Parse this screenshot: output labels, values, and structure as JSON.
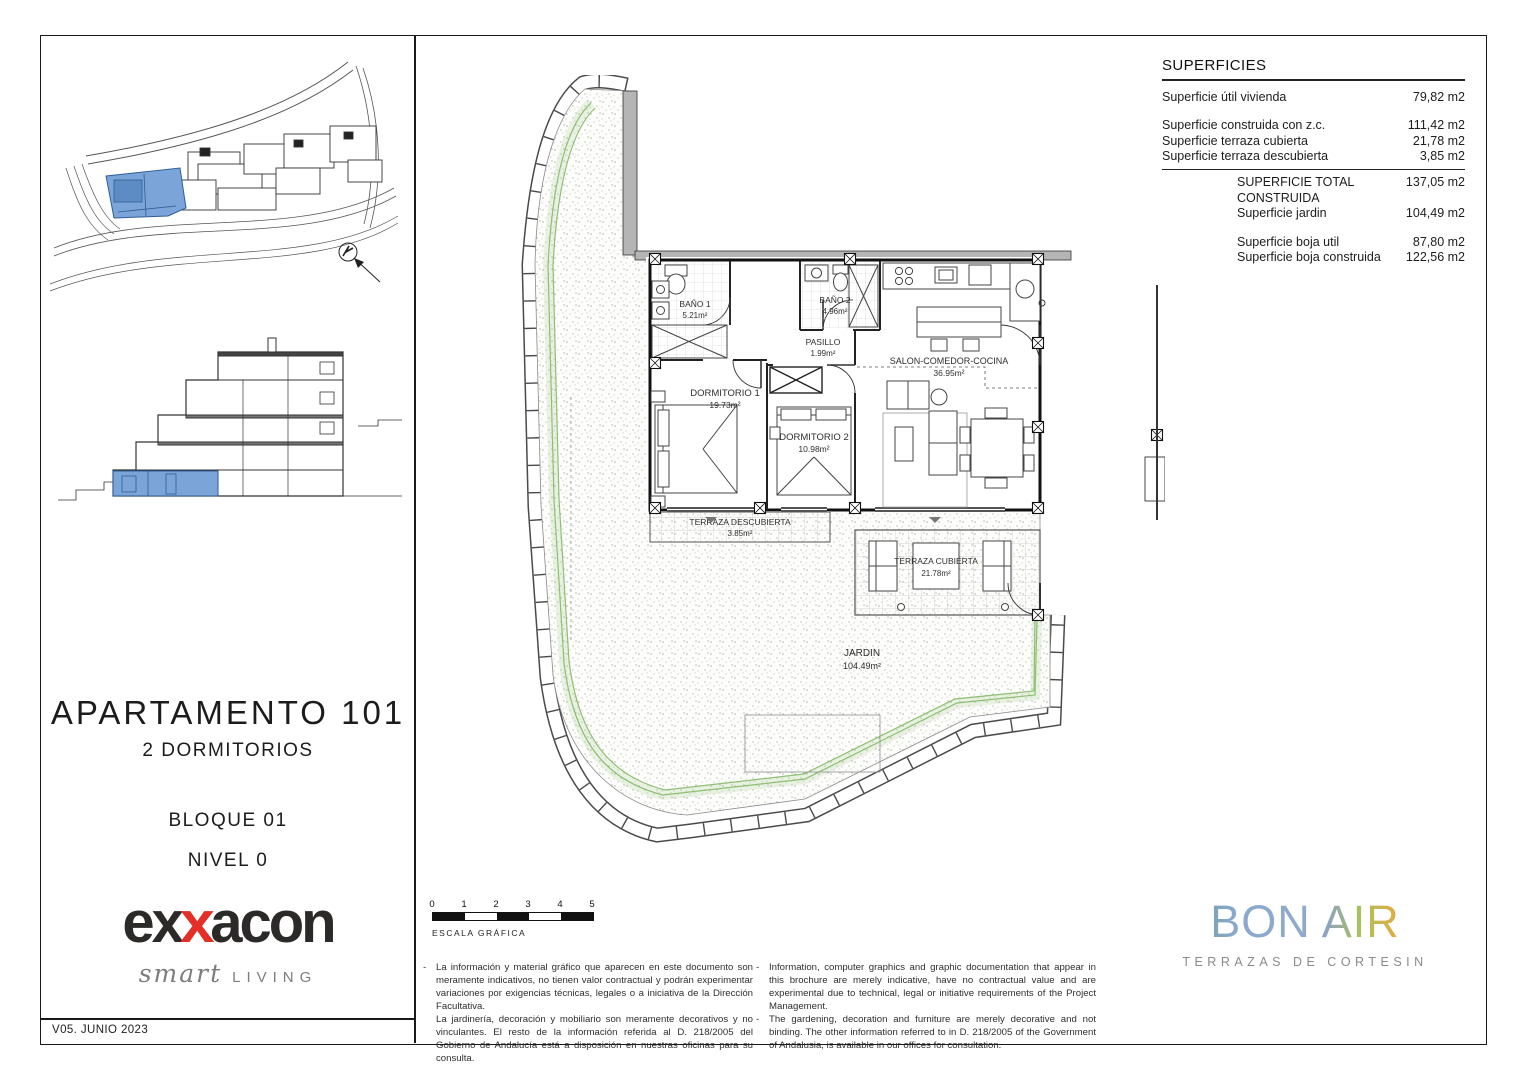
{
  "page": {
    "version": "V05. JUNIO 2023"
  },
  "title_block": {
    "title": "APARTAMENTO 101",
    "subtitle": "2 DORMITORIOS",
    "block": "BLOQUE 01",
    "level": "NIVEL 0"
  },
  "superficies": {
    "heading": "SUPERFICIES",
    "rows": [
      {
        "label": "Superficie útil vivienda",
        "value": "79,82 m2"
      },
      {
        "label": "Superficie construida con z.c.",
        "value": "111,42 m2"
      },
      {
        "label": "Superficie terraza cubierta",
        "value": "21,78 m2"
      },
      {
        "label": "Superficie terraza descubierta",
        "value": "3,85 m2"
      },
      {
        "label": "SUPERFICIE TOTAL CONSTRUIDA",
        "value": "137,05 m2"
      },
      {
        "label": "Superficie jardin",
        "value": "104,49 m2"
      },
      {
        "label": "Superficie boja util",
        "value": "87,80 m2"
      },
      {
        "label": "Superficie boja construida",
        "value": "122,56 m2"
      }
    ]
  },
  "plan": {
    "rooms": [
      {
        "name": "BAÑO 1",
        "area": "5.21m²"
      },
      {
        "name": "BAÑO 2",
        "area": "4.96m²"
      },
      {
        "name": "PASILLO",
        "area": "1.99m²"
      },
      {
        "name": "DORMITORIO 1",
        "area": "19.73m²"
      },
      {
        "name": "DORMITORIO 2",
        "area": "10.98m²"
      },
      {
        "name": "SALON-COMEDOR-COCINA",
        "area": "36.95m²"
      },
      {
        "name": "TERRAZA DESCUBIERTA",
        "area": "3.85m²"
      },
      {
        "name": "TERRAZA CUBIERTA",
        "area": "21.78m²"
      },
      {
        "name": "JARDIN",
        "area": "104.49m²"
      }
    ]
  },
  "scale_bar": {
    "ticks": [
      "0",
      "1",
      "2",
      "3",
      "4",
      "5"
    ],
    "label": "ESCALA GRÁFICA"
  },
  "disclaimer": {
    "bullet": "-",
    "es": [
      "La información y material gráfico que aparecen en este documento son meramente indicativos, no tienen valor contractual y podrán experimentar variaciones por exigencias técnicas, legales o a iniciativa de la Dirección Facultativa.",
      "La jardinería, decoración y mobiliario son meramente decorativos y no vinculantes. El resto de la información referida al D. 218/2005 del Gobierno de Andalucía está a disposición en nuestras oficinas para su consulta."
    ],
    "en": [
      "Information, computer graphics and graphic documentation that appear in this brochure are merely indicative, have no contractual value and are experimental due to technical, legal or initiative requirements of the Project Management.",
      "The gardening, decoration and furniture are merely decorative and not binding. The other information referred to in D. 218/2005 of the Government of Andalusia, is available in our offices for consultation."
    ]
  },
  "logos": {
    "exxacon": {
      "prefix": "ex",
      "accent": "x",
      "suffix": "acon",
      "tagline_script": "smart",
      "tagline_caps": "LIVING",
      "accent_color": "#e23028",
      "text_color": "#2b2a29"
    },
    "bonair": {
      "word1": "BON",
      "word2": "AIR",
      "subtitle": "TERRAZAS DE CORTESIN",
      "colors": [
        "#6fa08f",
        "#8aa8cf",
        "#a9c25d",
        "#f0a73f"
      ],
      "subtitle_color": "#8a8a8a"
    }
  },
  "colors": {
    "highlight_blue": "#7ba4d9",
    "hedge_green": "#8fbf72",
    "wall_gray": "#b5b5b5"
  }
}
